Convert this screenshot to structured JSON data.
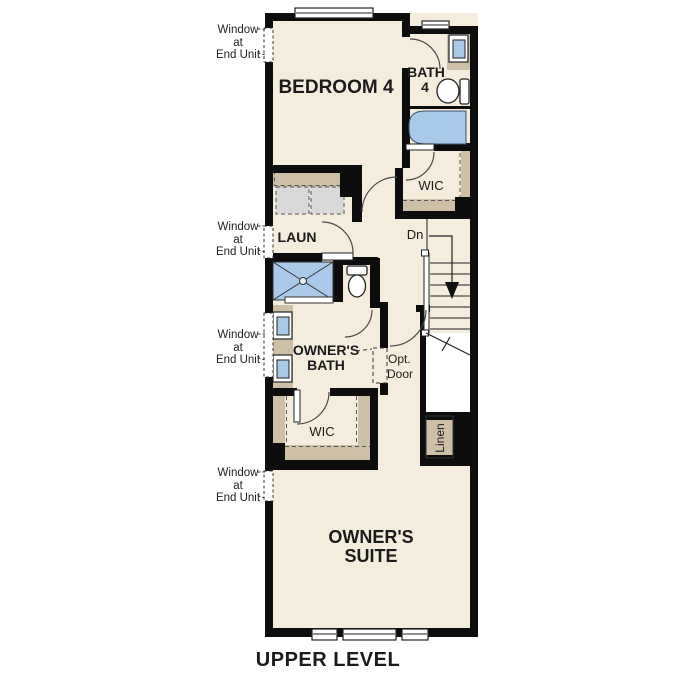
{
  "title": "UPPER LEVEL",
  "colors": {
    "floor": "#f4ecdc",
    "wall": "#0d0d0d",
    "cabinet": "#cdc0a6",
    "fixture_blue": "#a9c9e8",
    "appliance_gray": "#d9d9d9"
  },
  "rooms": {
    "bedroom4": "BEDROOM 4",
    "bath4": [
      "BATH",
      "4"
    ],
    "wic_upper": "WIC",
    "laundry": "LAUN",
    "owners_bath": [
      "OWNER'S",
      "BATH"
    ],
    "wic_lower": "WIC",
    "linen": "Linen",
    "owners_suite": [
      "OWNER'S",
      "SUITE"
    ]
  },
  "annotations": {
    "stairs_down": "Dn",
    "opt_door": [
      "Opt.",
      "Door"
    ],
    "window_note": [
      "Window",
      "at",
      "End Unit"
    ]
  }
}
